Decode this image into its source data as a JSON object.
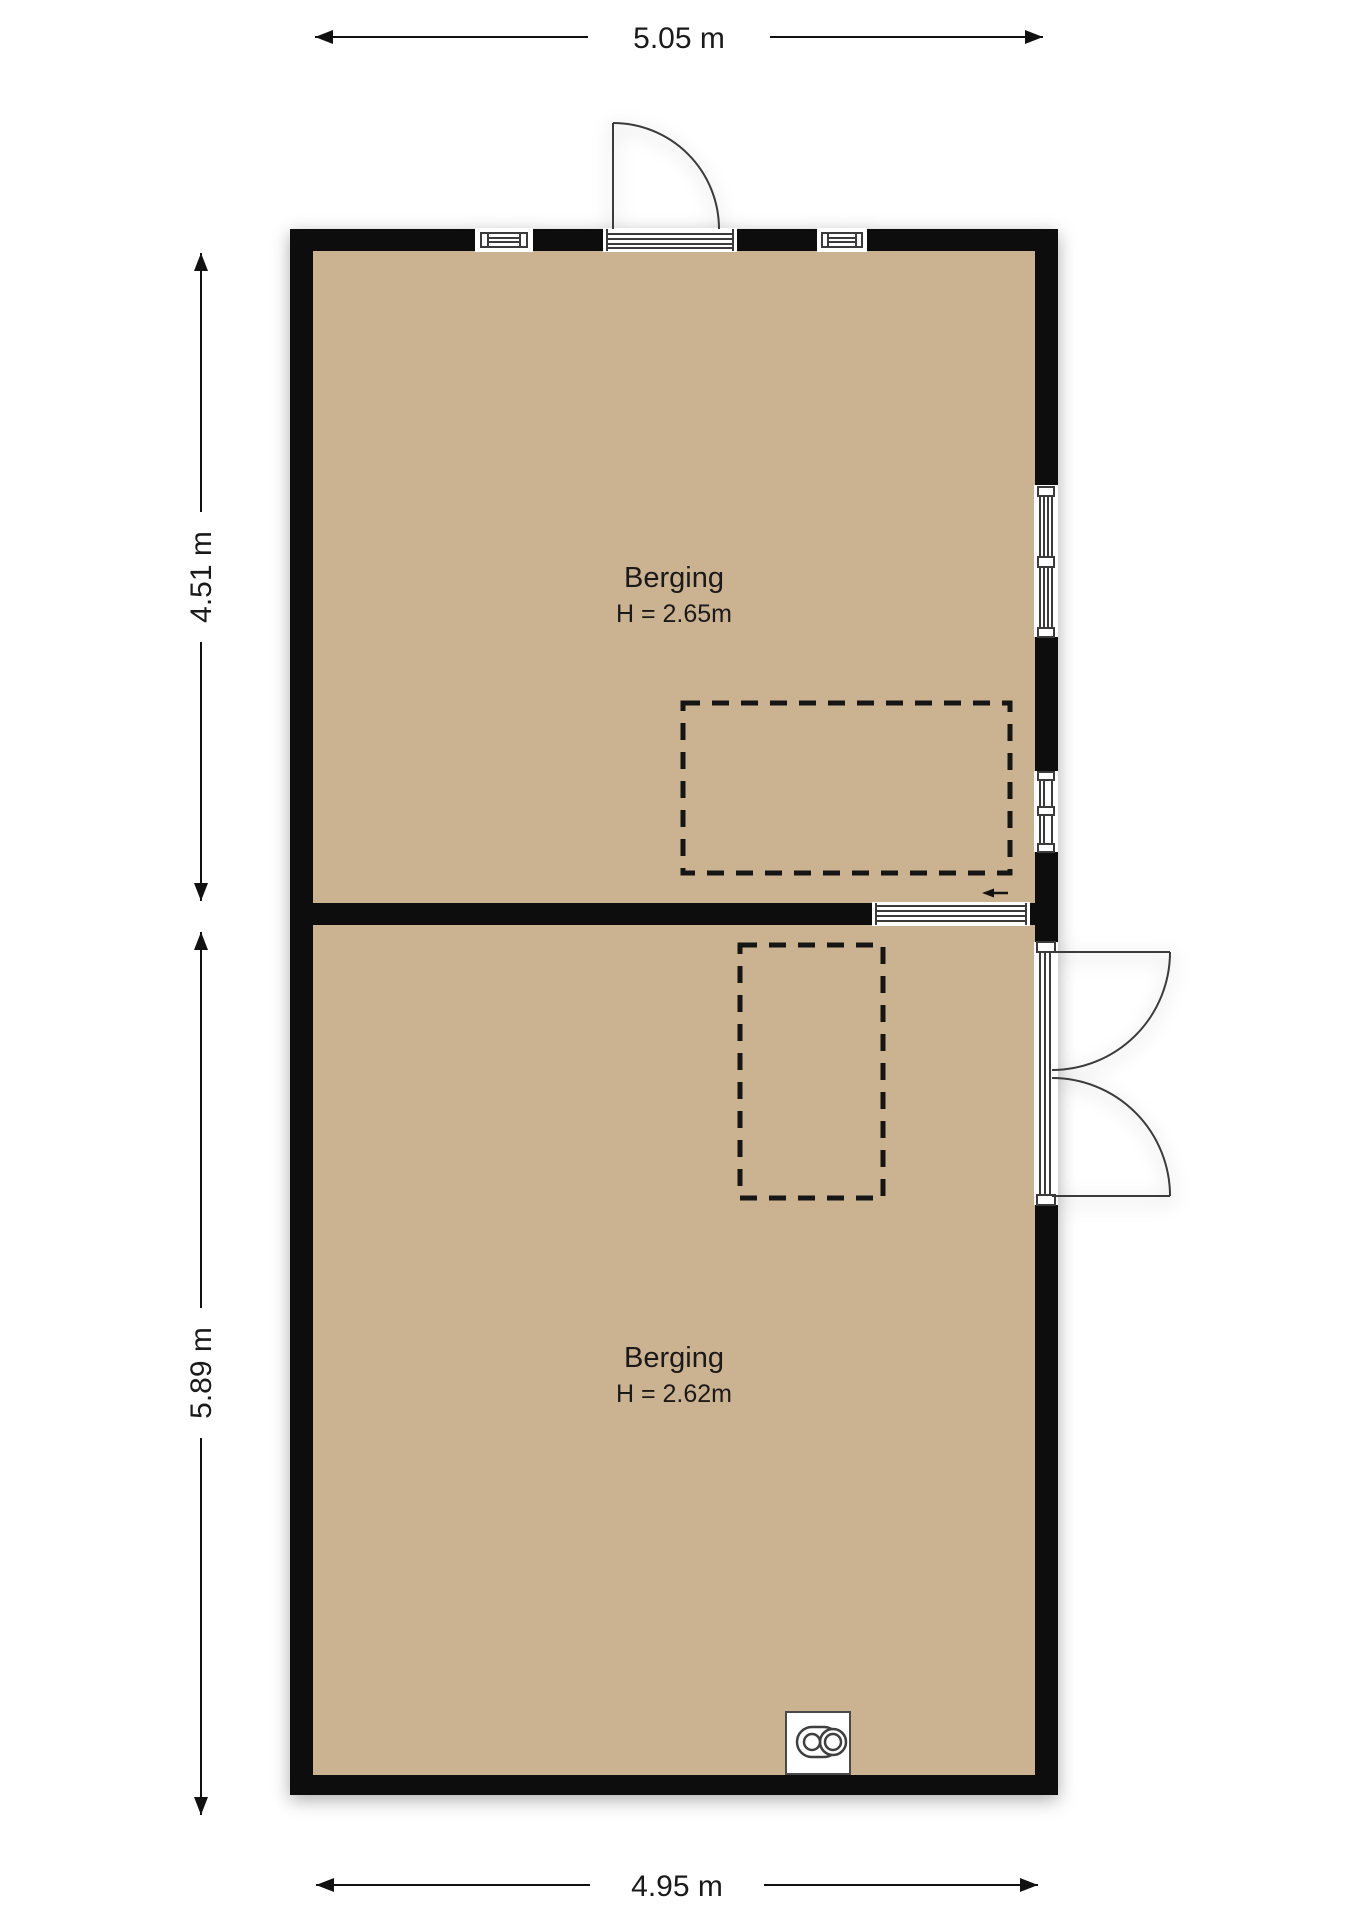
{
  "floorplan": {
    "dimensions": {
      "top": "5.05 m",
      "bottom": "4.95 m",
      "left_upper": "4.51 m",
      "left_lower": "5.89 m"
    },
    "rooms": [
      {
        "name": "Berging",
        "height_label": "H = 2.65m"
      },
      {
        "name": "Berging",
        "height_label": "H = 2.62m"
      }
    ],
    "colors": {
      "floor": "#cbb291",
      "wall": "#0a0a0a",
      "dash": "#151515",
      "line": "#3a3a3a",
      "background": "#ffffff"
    },
    "icons": {
      "appliance": "boiler-icon",
      "entrance_arrow": "arrow-left-icon"
    }
  }
}
